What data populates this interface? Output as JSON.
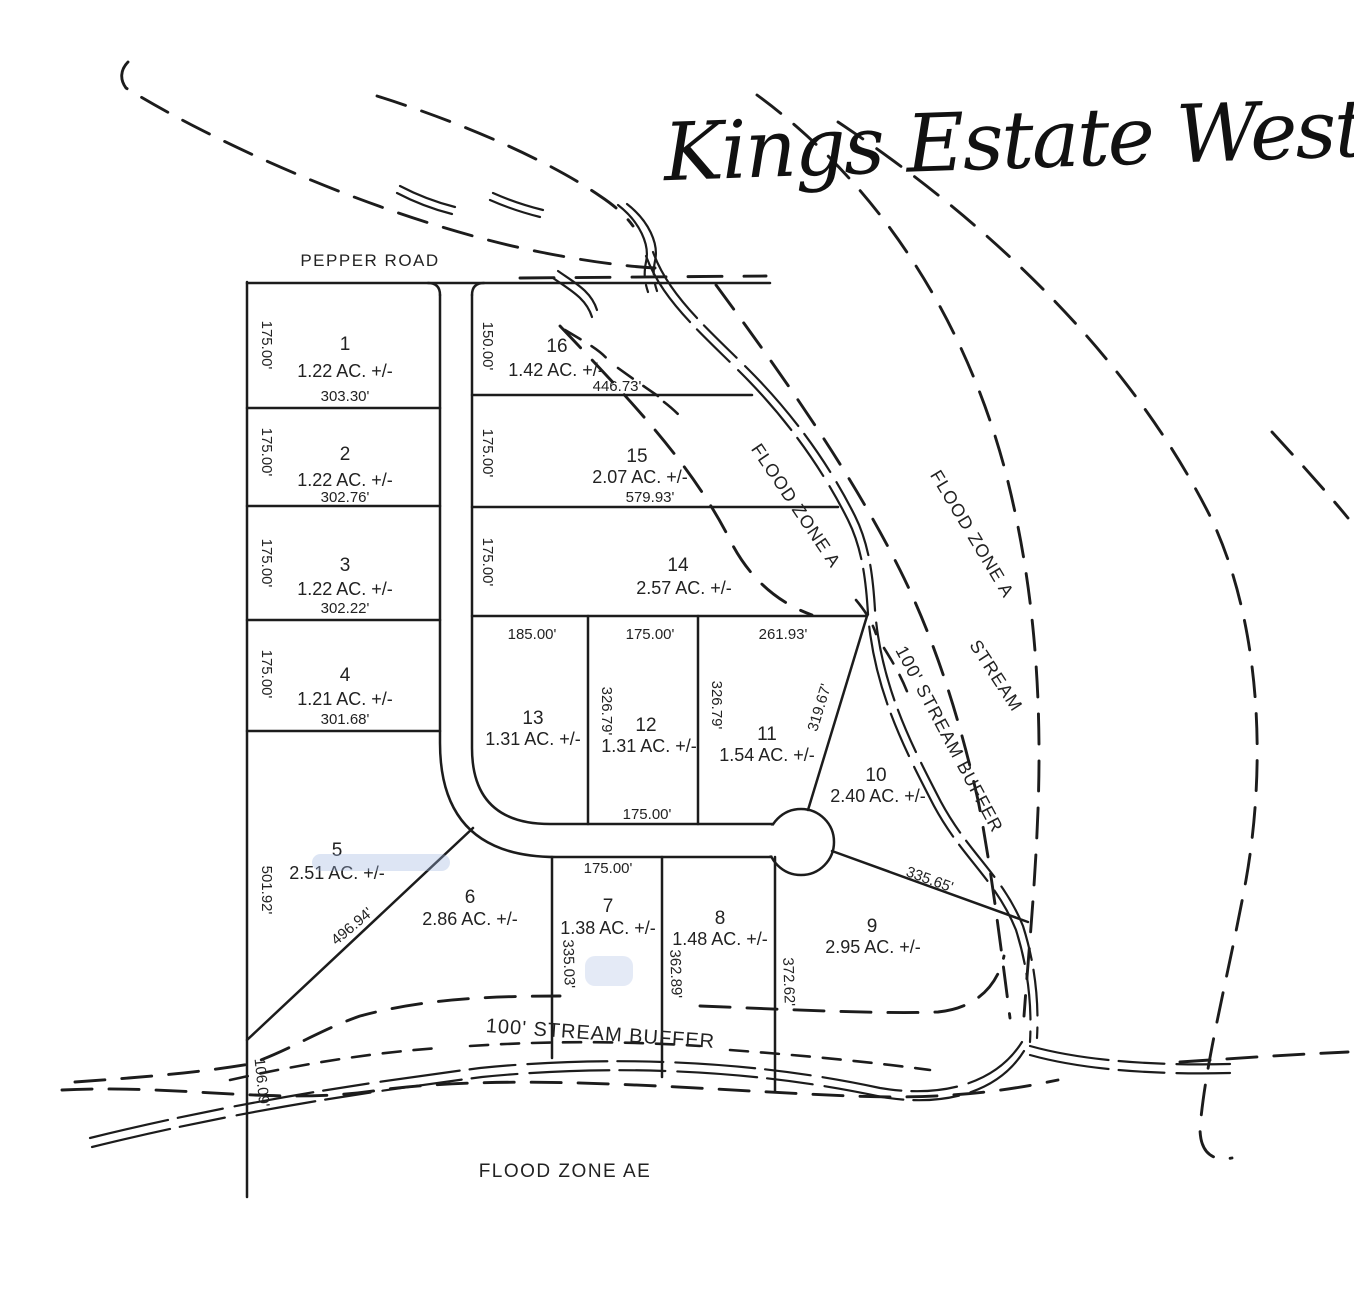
{
  "title": "Kings Estate West",
  "road_name": "PEPPER ROAD",
  "zones": {
    "flood_a_upper": "FLOOD ZONE A",
    "flood_a_outer": "FLOOD ZONE A",
    "flood_ae": "FLOOD ZONE AE",
    "stream": "STREAM",
    "buffer_right": "100' STREAM BUFFER",
    "buffer_bottom": "100' STREAM BUFFER"
  },
  "lots": {
    "lot1": {
      "number": "1",
      "area": "1.22 AC. +/-",
      "side": "175.00'",
      "width": "303.30'"
    },
    "lot2": {
      "number": "2",
      "area": "1.22 AC. +/-",
      "side": "175.00'",
      "width": "302.76'"
    },
    "lot3": {
      "number": "3",
      "area": "1.22 AC. +/-",
      "side": "175.00'",
      "width": "302.22'"
    },
    "lot4": {
      "number": "4",
      "area": "1.21 AC. +/-",
      "side": "175.00'",
      "width": "301.68'"
    },
    "lot5": {
      "number": "5",
      "area": "2.51 AC. +/-",
      "side": "501.92'",
      "diag": "496.94'",
      "south": "106.09'"
    },
    "lot6": {
      "number": "6",
      "area": "2.86 AC. +/-"
    },
    "lot7": {
      "number": "7",
      "area": "1.38 AC. +/-",
      "top": "175.00'",
      "side": "335.03'",
      "east": "362.89'"
    },
    "lot8": {
      "number": "8",
      "area": "1.48 AC. +/-",
      "east": "372.62'"
    },
    "lot9": {
      "number": "9",
      "area": "2.95 AC. +/-",
      "top": "335.65'"
    },
    "lot10": {
      "number": "10",
      "area": "2.40 AC. +/-",
      "west": "319.67'"
    },
    "lot11": {
      "number": "11",
      "area": "1.54 AC. +/-",
      "top": "261.93'",
      "west": "326.79'"
    },
    "lot12": {
      "number": "12",
      "area": "1.31 AC. +/-",
      "top": "175.00'",
      "west": "326.79'",
      "bottom": "175.00'"
    },
    "lot13": {
      "number": "13",
      "area": "1.31 AC. +/-",
      "top": "185.00'"
    },
    "lot14": {
      "number": "14",
      "area": "2.57 AC. +/-",
      "side": "175.00'"
    },
    "lot15": {
      "number": "15",
      "area": "2.07 AC. +/-",
      "side": "175.00'",
      "width": "579.93'"
    },
    "lot16": {
      "number": "16",
      "area": "1.42 AC. +/-",
      "side": "150.00'",
      "width": "446.73'"
    }
  }
}
